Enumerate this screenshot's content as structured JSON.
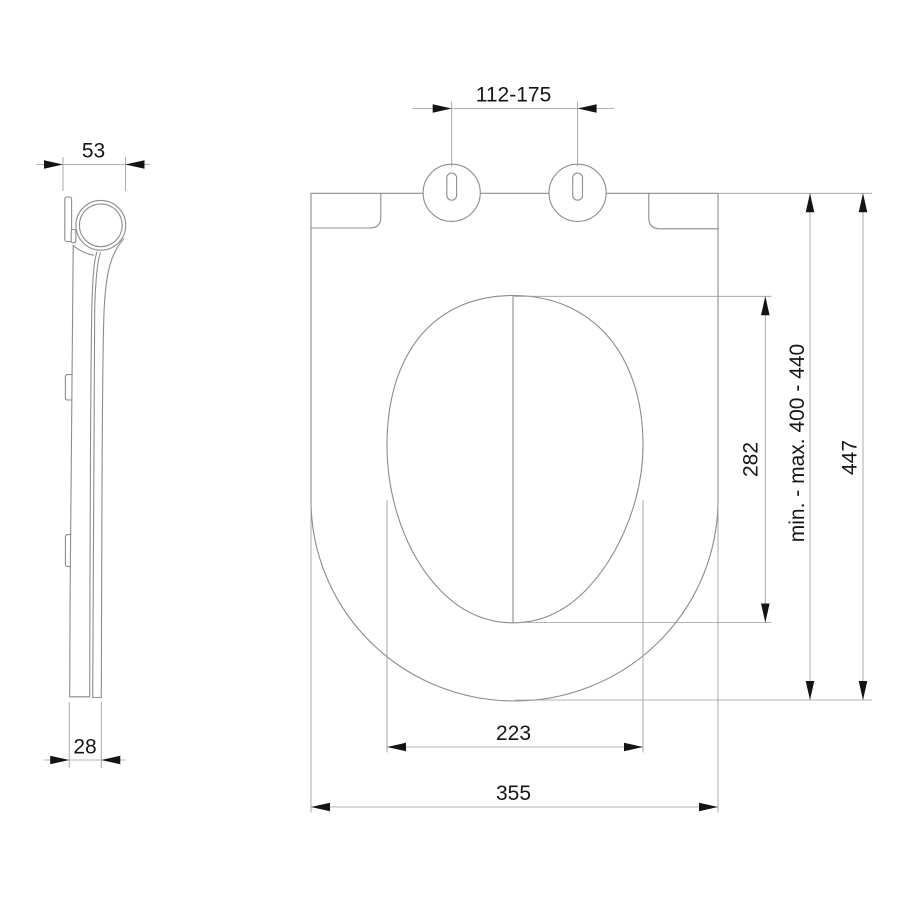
{
  "drawing": {
    "type": "technical dimension drawing - toilet seat",
    "background_color": "#ffffff",
    "outline_color": "#8c8c8c",
    "dimension_line_color": "#9b9b9b",
    "arrow_color": "#141414",
    "text_color": "#161616"
  },
  "side_view": {
    "name": "seat side profile",
    "dimensions": {
      "top_width": {
        "label": "53"
      },
      "bottom_thickness": {
        "label": "28"
      }
    }
  },
  "top_view": {
    "name": "seat top view",
    "dimensions": {
      "hinge_hole_spacing": {
        "label": "112-175"
      },
      "opening_length": {
        "label": "282"
      },
      "installation_range": {
        "label": "min. - max. 400 - 440"
      },
      "overall_length": {
        "label": "447"
      },
      "opening_width": {
        "label": "223"
      },
      "overall_width": {
        "label": "355"
      }
    }
  }
}
